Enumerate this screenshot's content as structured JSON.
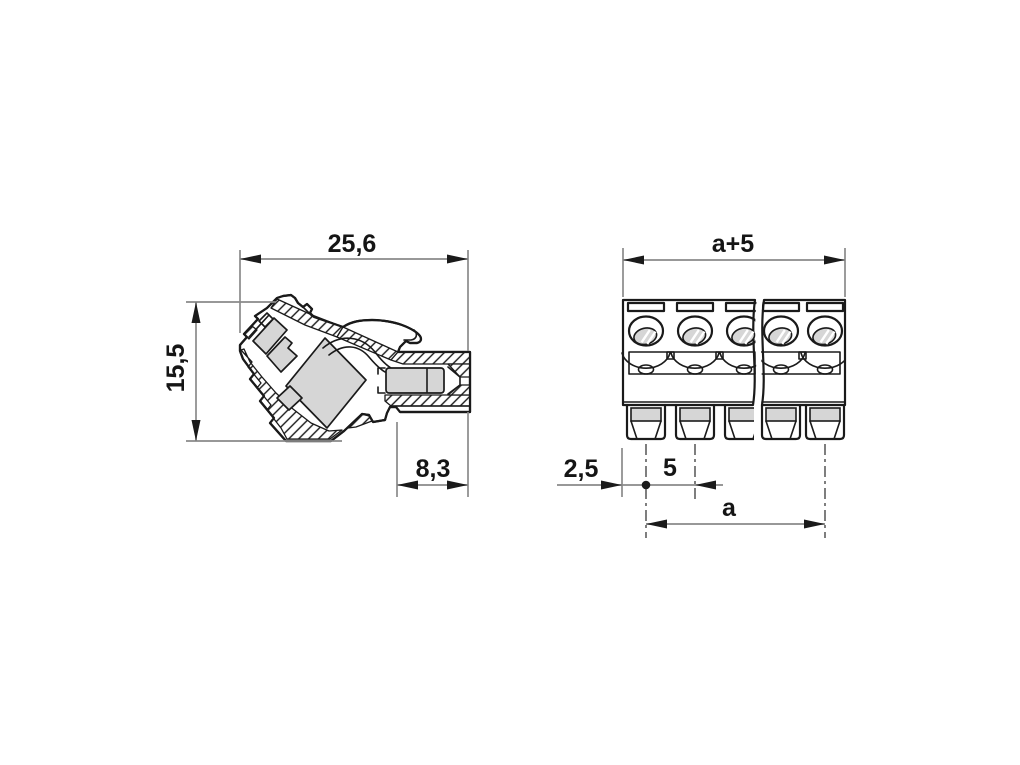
{
  "dimensions": {
    "side_view": {
      "width": "25,6",
      "height": "15,5",
      "plug_depth": "8,3"
    },
    "front_view": {
      "overall_width": "a+5",
      "edge_offset": "2,5",
      "pitch": "5",
      "span": "a"
    }
  },
  "front_view": {
    "positions_visible": 5,
    "position_centers_left": [
      646,
      695,
      744
    ],
    "position_centers_right": [
      781,
      825
    ]
  },
  "colors": {
    "line": "#1a1a1a",
    "dimension_line": "#8a8a8a",
    "section_gray": "#d6d6d6",
    "background": "#ffffff"
  }
}
